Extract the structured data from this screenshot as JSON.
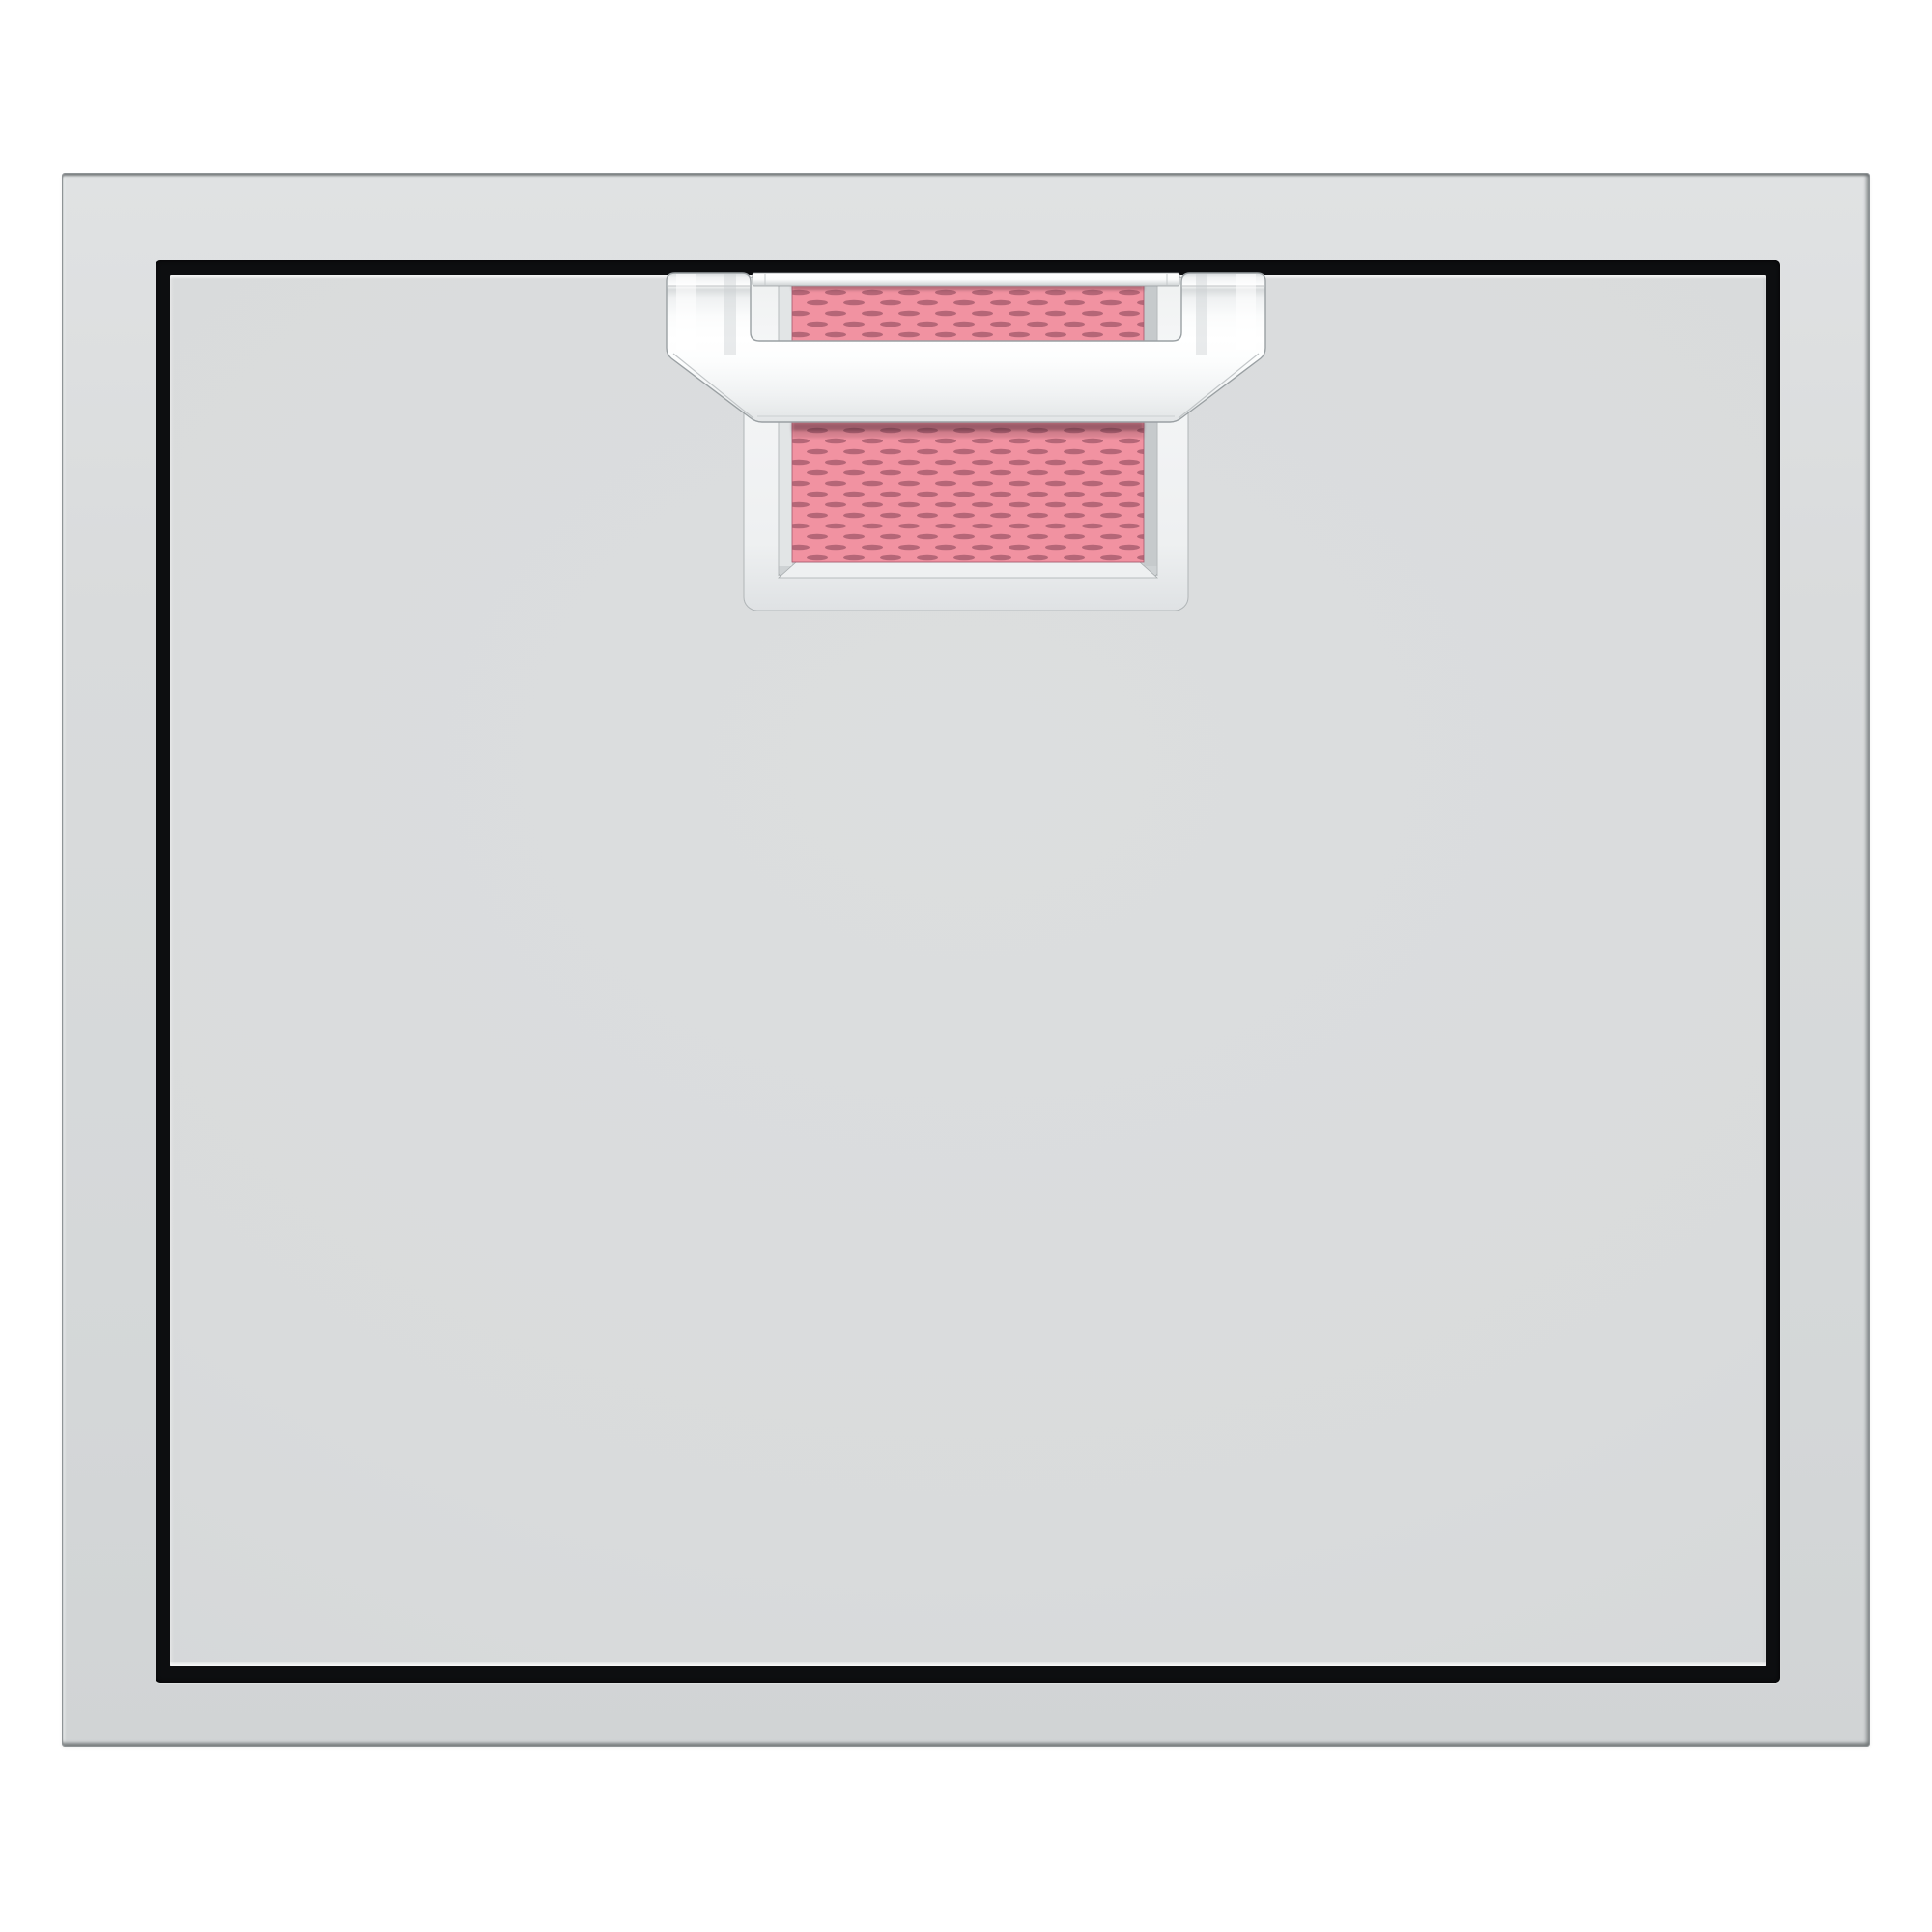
{
  "page": {
    "background": "#ffffff"
  },
  "product": {
    "name": "outdoor-kitchen-access-door",
    "view": "front",
    "parts": {
      "frame": "stainless-steel surround frame",
      "door": "single flat door panel",
      "reveal": "black gap between door and frame",
      "handle": "chrome towel-bar handle",
      "bezel": "chrome handle bezel plate",
      "insert_upper": "pink woven accent insert, upper strip",
      "insert_lower": "pink woven accent insert, lower panel"
    }
  },
  "colors": {
    "background": "#ffffff",
    "steel_face": "#d9dbdc",
    "steel_face_dark": "#cfd2d4",
    "steel_edge_dark": "#7a7f81",
    "reveal_black": "#0d0e10",
    "chrome_white": "#ffffff",
    "chrome_light": "#f2f4f4",
    "chrome_mid": "#dfe2e3",
    "chrome_edge": "#9aa0a3",
    "accent_pink": "#f192a1",
    "accent_pink_dark": "#aa5e70",
    "accent_pink_shadow": "#4a2530"
  }
}
